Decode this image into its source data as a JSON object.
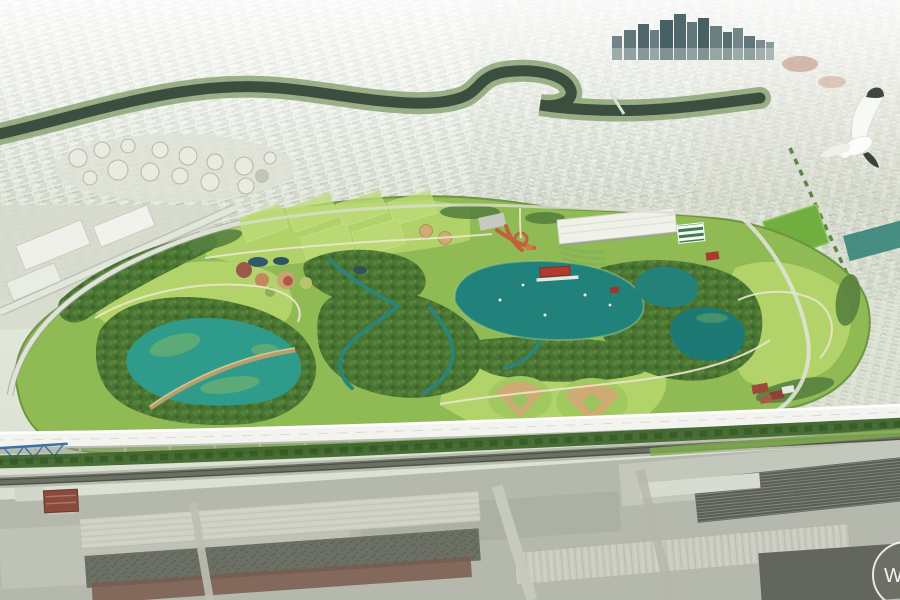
{
  "scene": {
    "description": "Aerial perspective rendering of a large urban park master plan: lakes and lagoons, sports fields, forests and meadows, an elevated highway and rail corridor crossing the foreground, industrial warehouses at the bottom, hazy city fabric and a downtown skyline on the horizon, with a seagull flying at upper right",
    "elements": [
      "city-haze",
      "downtown-skyline",
      "winding-river",
      "oil-tank-farm",
      "commercial-strip",
      "park-meadows",
      "sports-fields",
      "garden-plots",
      "central-lake",
      "west-lagoon",
      "east-ponds",
      "wetland-creeks",
      "boathouse",
      "field-house",
      "gateway-plaza",
      "baseball-diamonds",
      "elevated-highway",
      "blue-truss-bridge",
      "rail-corridor",
      "industrial-warehouses",
      "brick-building",
      "seagull",
      "watermark"
    ]
  },
  "watermark": {
    "text": "WR"
  },
  "palette": {
    "sky_haze": "#f1f4ee",
    "urban_base": "#dde2d6",
    "skyline_towers": "#476064",
    "river_water": "#3c4f3e",
    "tank_white": "#e9ebe1",
    "park_meadow": "#8fba54",
    "meadow_light": "#b2d36a",
    "forest_green": "#4a7433",
    "lake_teal": "#21827b",
    "lagoon_teal": "#2f9b8a",
    "algae_green": "#7fb86a",
    "plaza_terracotta": "#c2603c",
    "boathouse_red": "#b23a2e",
    "diamond_tan": "#cdab72",
    "causeway_tan": "#b49f6d",
    "highway_deck": "#f3f4f0",
    "bridge_blue": "#3f6fa8",
    "rail_dark": "#6a7062",
    "industrial_base": "#b5b8ac",
    "warehouse_dark": "#6b6f64",
    "brick_red": "#8a4a3c",
    "watermark_white": "#ffffff"
  }
}
